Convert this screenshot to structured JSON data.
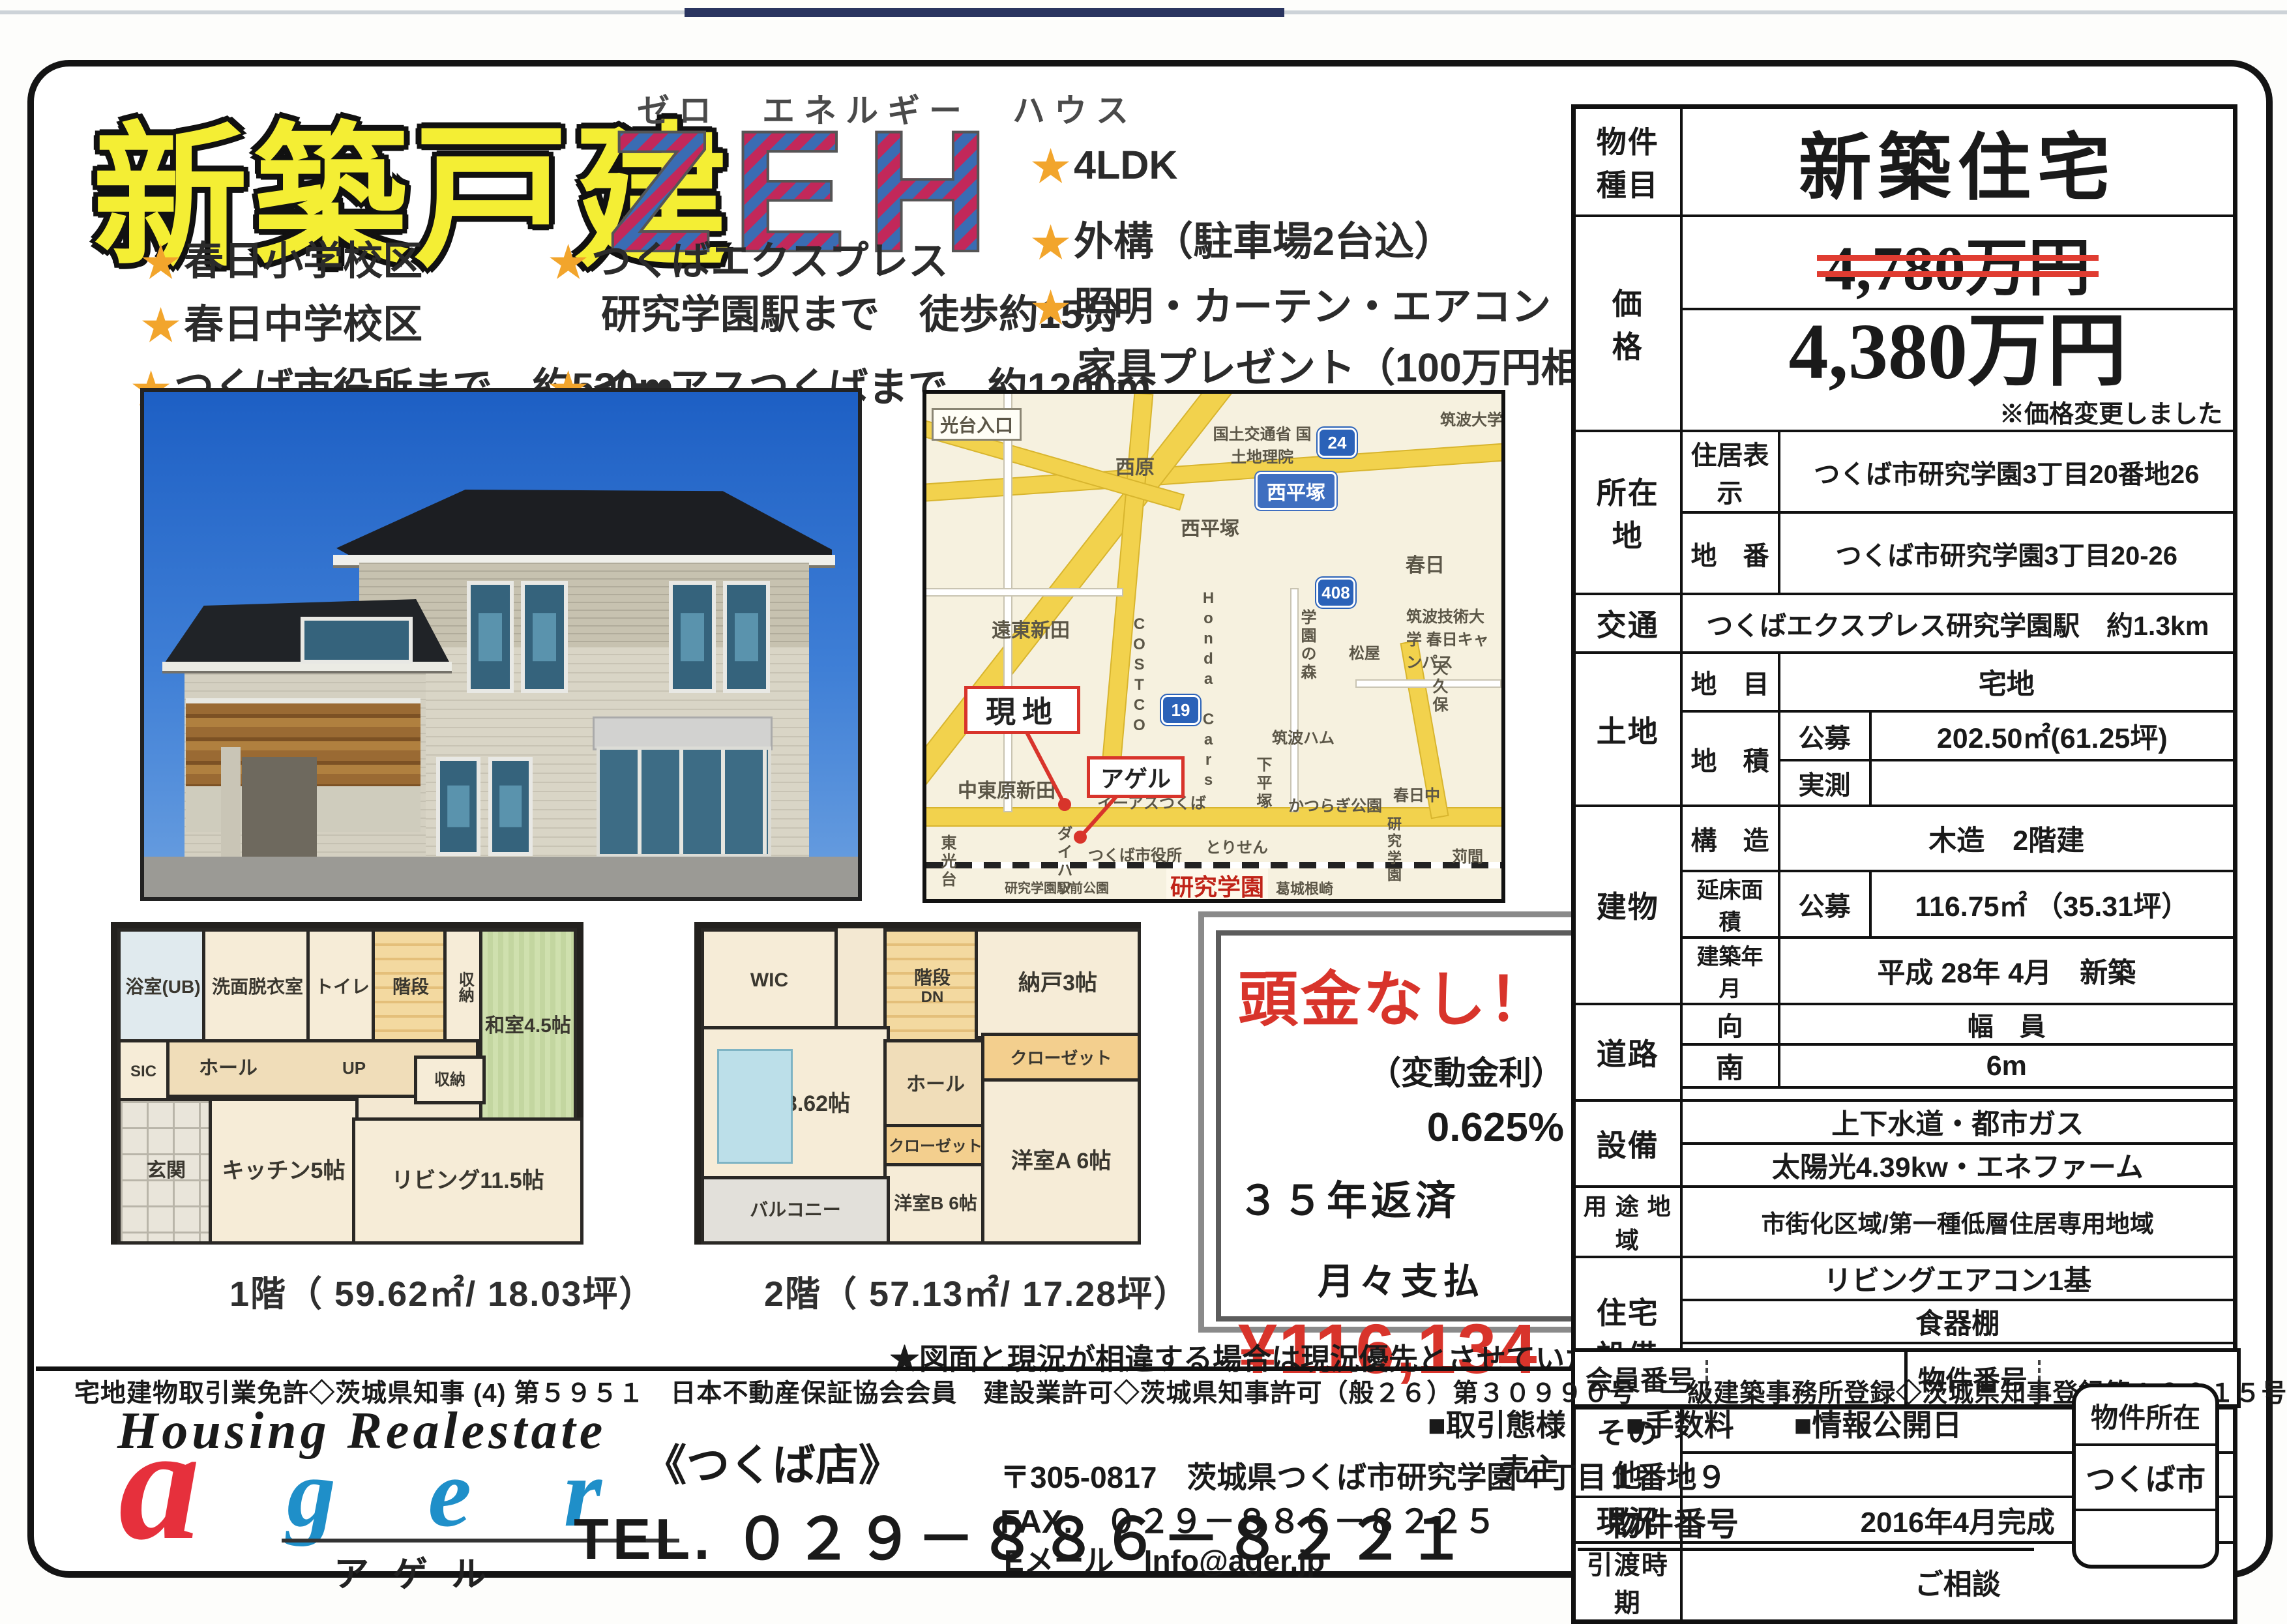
{
  "colors": {
    "accent_red": "#d8342b",
    "title_yellow": "#f4ee34",
    "zeh_blue": "#3a6cb3",
    "zeh_red": "#c2285a",
    "ager_red": "#e6303c",
    "ager_blue": "#1f8fc9",
    "map_road_yellow": "#f2d24d",
    "tatami_green": "#cfe0ae"
  },
  "header": {
    "title": "新築戸建",
    "zeh_ruby": "ゼロ　エネルギー　ハウス",
    "zeh": "ZEH"
  },
  "features": {
    "col1": [
      "春日小学校区",
      "春日中学校区",
      "つくば市役所まで　約530m"
    ],
    "col2_line1": "つくばエクスプレス",
    "col2_line2": "研究学園駅まで　徒歩約15分",
    "col2_line3": "イーアスつくばまで　約1200m",
    "col3": [
      "4LDK",
      "外構（駐車場2台込）",
      "照明・カーテン・エアコン"
    ],
    "gift": "家具プレゼント（100万円相当!!）"
  },
  "map": {
    "labels": [
      "光台入口",
      "西原",
      "国土交通省 国土地理院",
      "西平塚",
      "西平塚",
      "春日",
      "筑波大学",
      "筑波技術大学 春日キャンパス",
      "松屋",
      "天久保",
      "学園の森",
      "筑波ハム",
      "下平塚",
      "かつらぎ公園",
      "春日中",
      "COSTCO",
      "Honda Cars",
      "遠東新田",
      "中東原新田",
      "東光台",
      "ダイハツ",
      "つくば市役所",
      "とりせん",
      "イーアスつくば",
      "研究学園",
      "研究学園駅前公園",
      "葛城根崎",
      "苅間",
      "研究学園",
      "現地",
      "アゲル"
    ],
    "shields": [
      "24",
      "408",
      "19"
    ]
  },
  "spec": {
    "property_type_label": "物件種目",
    "property_type": "新築住宅",
    "price_label": "価　　格",
    "old_price": "4,780万円",
    "new_price": "4,380万円",
    "price_note": "※価格変更しました",
    "location_label": "所在地",
    "jukyo_label": "住居表示",
    "jukyo_value": "つくば市研究学園3丁目20番地26",
    "chiban_label": "地　番",
    "chiban_value": "つくば市研究学園3丁目20-26",
    "kotsu_label": "交通",
    "kotsu_value": "つくばエクスプレス研究学園駅　約1.3km",
    "tochi_label": "土地",
    "chimoku_label": "地　目",
    "chimoku_value": "宅地",
    "chiseki_label": "地　積",
    "kobo_label": "公募",
    "chiseki_value": "202.50㎡(61.25坪)",
    "jissoku_label": "実測",
    "jissoku_value": "",
    "tatemono_label": "建物",
    "kozo_label": "構　造",
    "kozo_value": "木造　2階建",
    "nobeyuka_label": "延床面積",
    "nobeyuka_kobo": "公募",
    "nobeyuka_value": "116.75㎡ （35.31坪）",
    "chikunen_label": "建築年月",
    "chikunen_value": "平成 28年 4月　新築",
    "doro_label": "道路",
    "muki_label": "向",
    "fukuin_label": "幅　員",
    "muki_value": "南",
    "fukuin_value": "6m",
    "setsubi_label": "設備",
    "setsubi_1": "上下水道・都市ガス",
    "setsubi_2": "太陽光4.39kw・エネファーム",
    "yoto_label": "用 途 地 域",
    "yoto_value": "市街化区域/第一種低層住居専用地域",
    "jutaku_label": "住宅設備",
    "jutaku_1": "リビングエアコン1基",
    "jutaku_2": "食器棚",
    "sonota_label": "その他",
    "genkyo_label": "現況",
    "genkyo_value": "2016年4月完成",
    "hikiwatashi_label": "引渡時期",
    "hikiwatashi_value": "ご相談",
    "member_no_label": "会員番号",
    "bukken_no_label": "物件番号"
  },
  "payment": {
    "head": "頭金なし！",
    "sub": "（変動金利）",
    "rate": "0.625%",
    "years": "３５年返済",
    "monthly_label": "月々支払",
    "amount": "¥116,134"
  },
  "floorplans": {
    "f1": {
      "caption": "1階（ 59.62㎡/ 18.03坪）",
      "rooms": {
        "bath": "浴室(UB)",
        "wash": "洗面脱衣室",
        "toilet": "トイレ",
        "stairs": "階段",
        "up": "UP",
        "closet1": "収納",
        "closet2": "収納",
        "washitsu": "和室4.5帖",
        "hall": "ホール",
        "sic": "SIC",
        "genkan": "玄関",
        "kitchen": "キッチン5帖",
        "living": "リビング11.5帖"
      }
    },
    "f2": {
      "caption": "2階（ 57.13㎡/ 17.28坪）",
      "rooms": {
        "wic": "WIC",
        "stairs": "階段",
        "dn": "DN",
        "nando": "納戸3帖",
        "closetA": "クローゼット",
        "closetB": "クローゼット",
        "shinshitsu": "寝室8.62帖",
        "hall": "ホール",
        "yoshitsuB": "洋室B 6帖",
        "yoshitsuA": "洋室A 6帖",
        "balcony": "バルコニー"
      }
    }
  },
  "note": "★図面と現況が相違する場合は現況優先とさせていただきます",
  "footer": {
    "license": "宅地建物取引業免許◇茨城県知事 (4) 第５９５１　日本不動産保証協会会員　建設業許可◇茨城県知事許可（般２６）第３０９９０号　一級建築事務所登録◇茨城県知事登録第Ａ３０１５号",
    "brand_top": "Housing Realestate",
    "brand_a": "a",
    "brand_ger": "g e r",
    "brand_kana": "アゲル",
    "store": "《つくば店》",
    "tel": "TEL. ０２９－８８６－８２２１",
    "addr": "〒305-0817　茨城県つくば市研究学園４丁目１番地９",
    "fax": "FAX.　０２９－８８６－８２２５",
    "email": "Eメール　Info@ager.jp",
    "deal": "■取引態様　　■手数料　　■情報公開日",
    "deal_value": "売主",
    "bukken_no": "物件番号",
    "loc_box_title": "物件所在",
    "loc_box_value": "つくば市"
  }
}
